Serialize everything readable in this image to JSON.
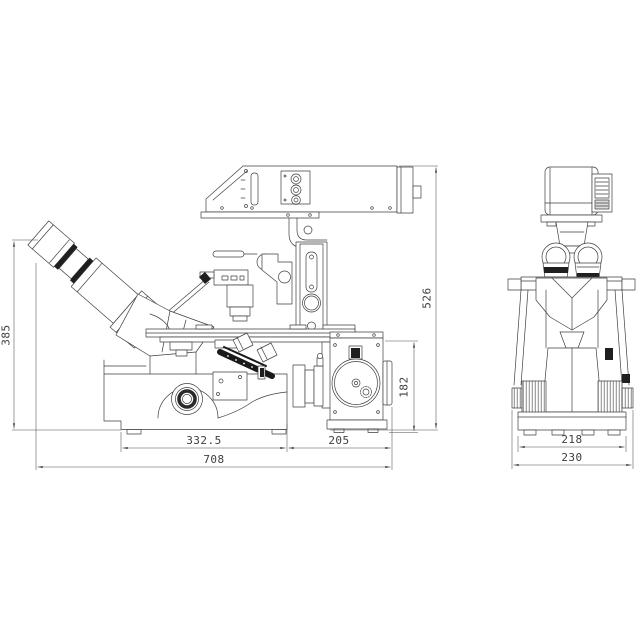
{
  "colors": {
    "line": "#3f3f3f",
    "dimension_line": "#4f4f4f",
    "dark_fill": "#1f1f1f",
    "background": "#ffffff"
  },
  "views": {
    "side": {
      "dimensions": {
        "eyepiece_height": "385",
        "overall_height": "526",
        "port_height": "182",
        "base_width": "332.5",
        "port_width": "205",
        "overall_width": "708"
      }
    },
    "front": {
      "dimensions": {
        "base_width": "218",
        "overall_width": "230"
      }
    }
  }
}
